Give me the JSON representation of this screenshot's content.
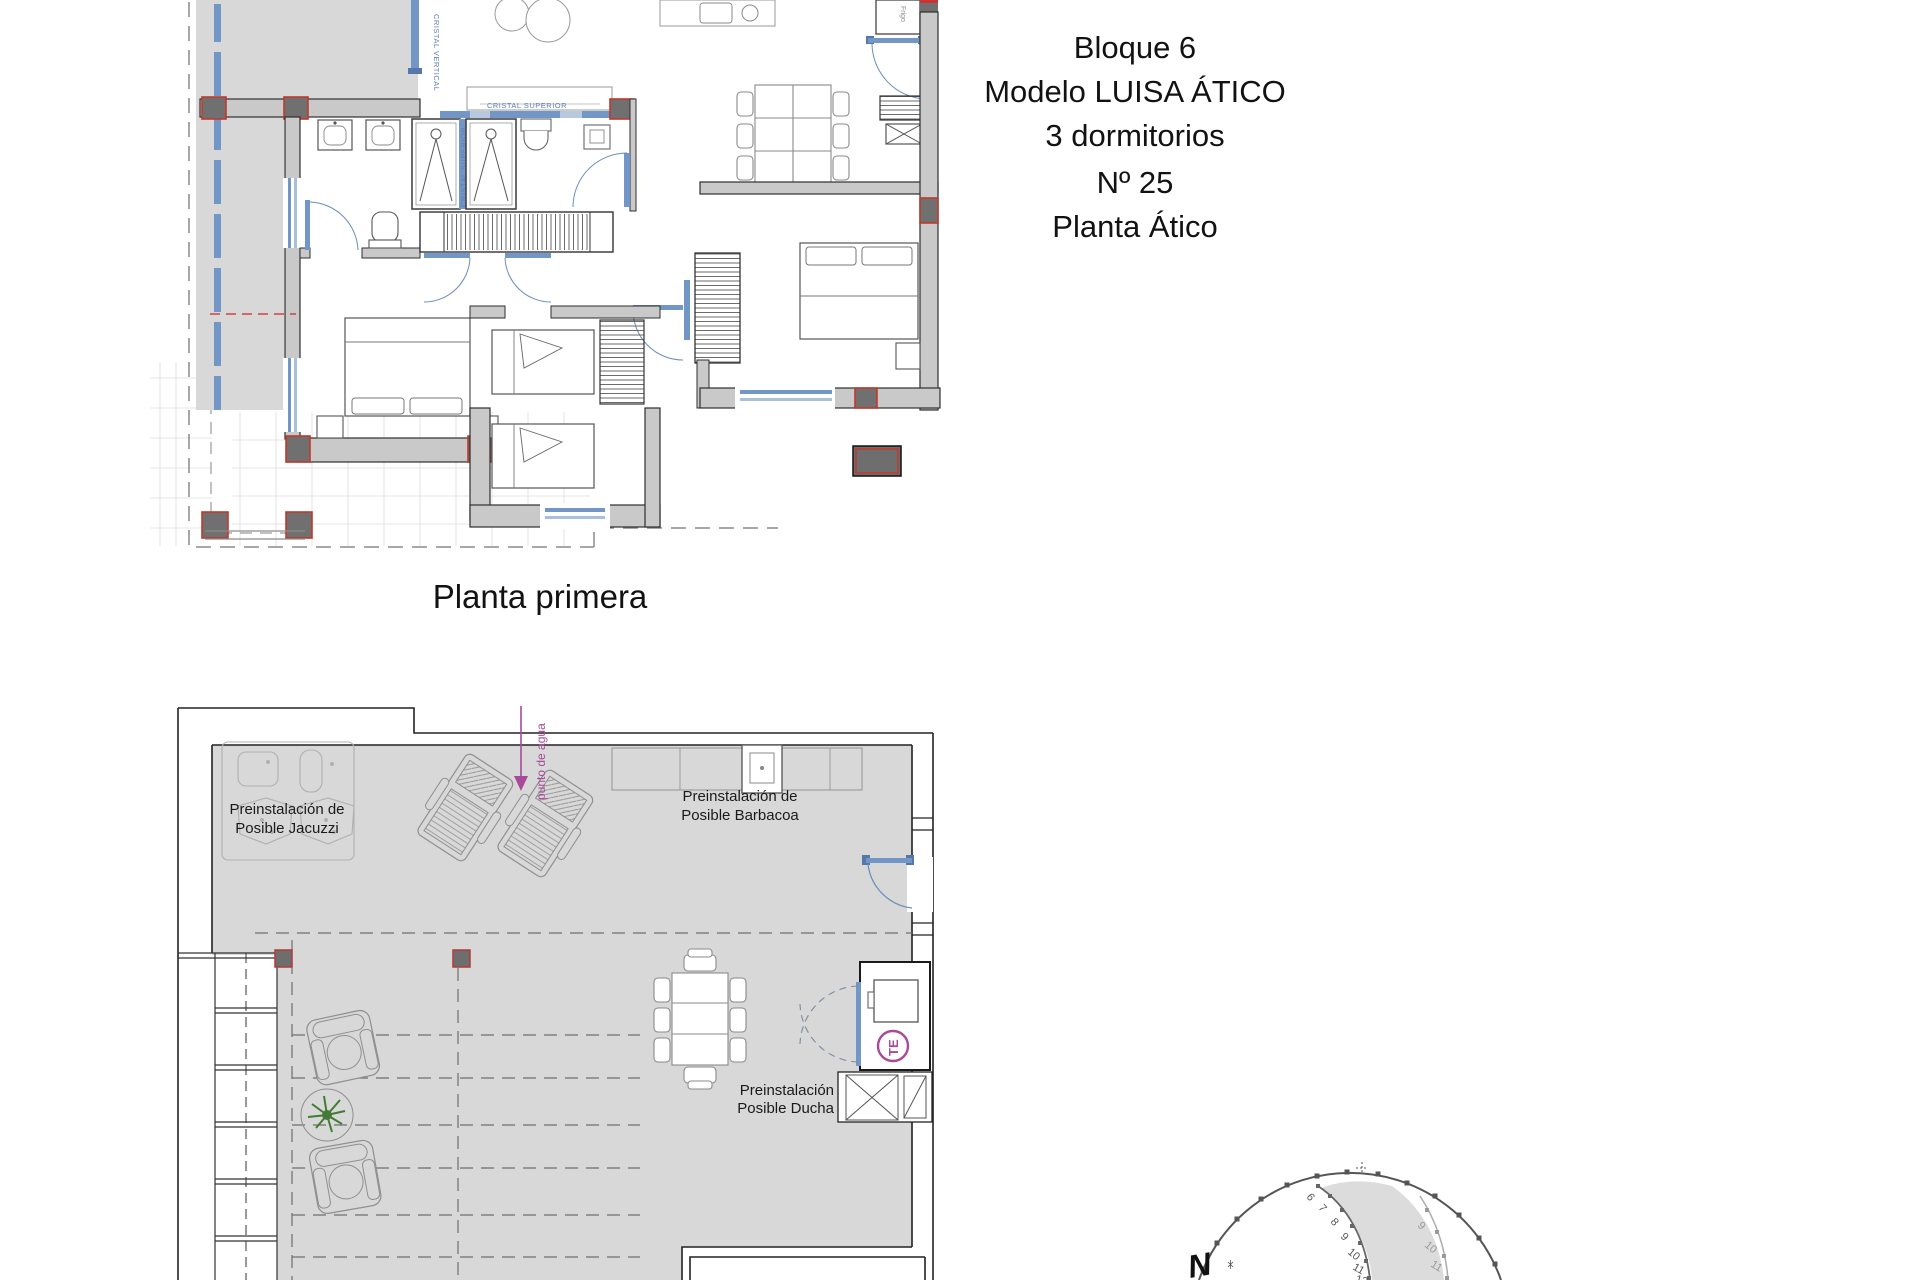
{
  "header": {
    "line1": "Bloque 6",
    "line2": "Modelo LUISA ÁTICO",
    "line3": "3 dormitorios",
    "line4": "Nº 25",
    "line5": "Planta Ático"
  },
  "plan_primera": {
    "label": "Planta primera",
    "glazing_vertical": "CRISTAL VERTICAL",
    "glazing_upper_divider": "CRISTAL SUPERIOR",
    "glazing_upper_band": "CRISTAL SUPERIOR",
    "fridge": "Frigo"
  },
  "plan_atico": {
    "jacuzzi_line1": "Preinstalación de",
    "jacuzzi_line2": "Posible Jacuzzi",
    "barbacoa_line1": "Preinstalación de",
    "barbacoa_line2": "Posible Barbacoa",
    "ducha_line1": "Preinstalación",
    "ducha_line2": "Posible Ducha",
    "punto_agua": "punto de agua",
    "te_badge": "TE"
  },
  "sun_diagram": {
    "north": "N",
    "hours_main": [
      "6",
      "7",
      "8",
      "9",
      "10",
      "11",
      "12"
    ],
    "hours_secondary": [
      "9",
      "10",
      "11"
    ]
  },
  "colors": {
    "terrace_gray": "#d8d8d8",
    "wall_gray": "#c9c9c9",
    "column_dark": "#707070",
    "column_red": "#c0392b",
    "glazing_blue": "#7296c5",
    "door_blue": "#6b8cba",
    "accent_purple": "#a84a9a",
    "plant_green": "#3f7d32"
  }
}
